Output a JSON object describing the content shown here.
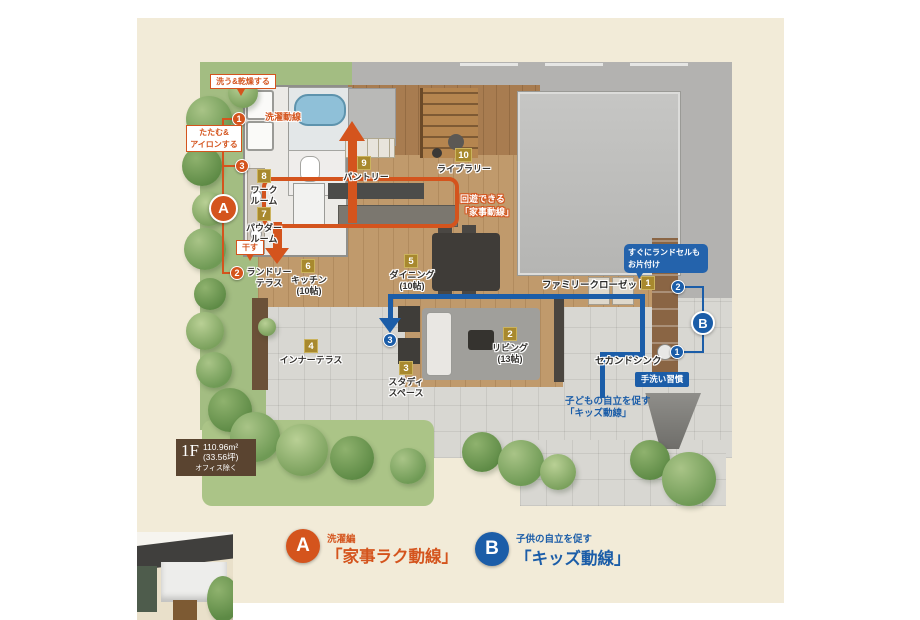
{
  "colors": {
    "orange": "#d4541d",
    "blue": "#1b5da8",
    "gold": "#a8892e",
    "area_box_brown": "#5a4430",
    "background_beige": "#f2ebd8"
  },
  "plan": {
    "rooms": [
      {
        "num": "1",
        "line1": "ファミリークローゼット",
        "line2": ""
      },
      {
        "num": "2",
        "line1": "リビング",
        "line2": "(13帖)"
      },
      {
        "num": "3",
        "line1": "スタディ",
        "line2": "スペース"
      },
      {
        "num": "4",
        "line1": "インナーテラス",
        "line2": ""
      },
      {
        "num": "5",
        "line1": "ダイニング",
        "line2": "(10帖)"
      },
      {
        "num": "6",
        "line1": "キッチン",
        "line2": "(10帖)"
      },
      {
        "num": "7",
        "line1": "パウダー",
        "line2": "ルーム"
      },
      {
        "num": "8",
        "line1": "ワーク",
        "line2": "ルーム"
      },
      {
        "num": "9",
        "line1": "パントリー",
        "line2": ""
      },
      {
        "num": "10",
        "line1": "ライブラリー",
        "line2": ""
      }
    ],
    "laundry_terrace": {
      "marker": "2",
      "line1": "ランドリー",
      "line2": "テラス"
    }
  },
  "route_a": {
    "letter": "A",
    "wash_label": "洗う&乾燥する",
    "fold_label_1": "たたむ&",
    "fold_label_2": "アイロンする",
    "dry_label": "干す",
    "laundry_flow_label": "洗濯動線",
    "loop_label_1": "回遊できる",
    "loop_label_2": "「家事動線」",
    "steps": {
      "s1": "1",
      "s2": "2",
      "s3": "3"
    }
  },
  "route_b": {
    "letter": "B",
    "bubble_line1": "すぐにランドセルも",
    "bubble_line2": "お片付け",
    "habit_label": "手洗い習慣",
    "sink_label": "セカンドシンク",
    "kids_note_1": "子どもの自立を促す",
    "kids_note_2": "「キッズ動線」",
    "steps": {
      "s1": "1",
      "s2": "2",
      "s3": "3"
    }
  },
  "area_box": {
    "floor": "1F",
    "area": "110.96m²",
    "tsubo": "(33.56坪)",
    "note": "オフィス除く"
  },
  "legend": {
    "a_letter": "A",
    "a_tag": "洗濯編",
    "a_title": "「家事ラク動線」",
    "b_letter": "B",
    "b_tag": "子供の自立を促す",
    "b_title": "「キッズ動線」"
  }
}
